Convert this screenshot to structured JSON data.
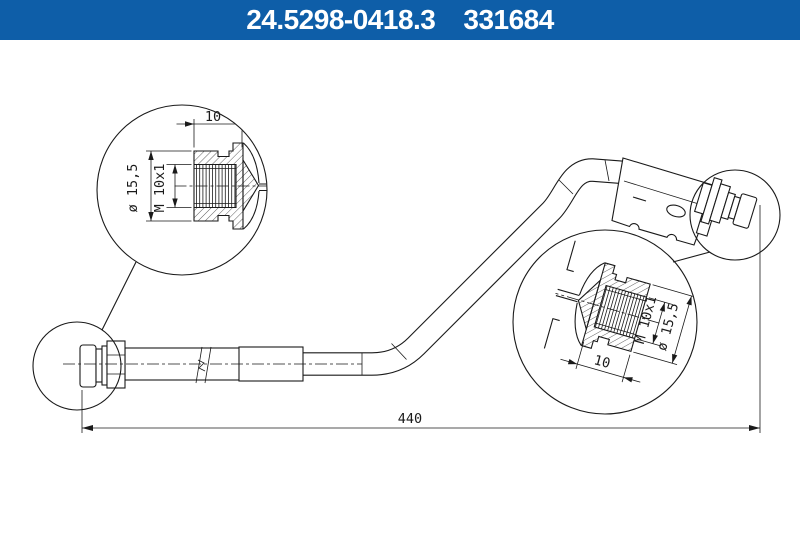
{
  "header": {
    "part_number": "24.5298-0418.3",
    "catalog_number": "331684"
  },
  "colors": {
    "header_bg": "#0e5ea8",
    "header_text": "#ffffff",
    "line": "#1a1a1a",
    "background": "#ffffff"
  },
  "dimensions": {
    "overall_length": "440"
  },
  "left_detail": {
    "length": "10",
    "thread": "M 10x1",
    "diameter": "ø 15,5"
  },
  "right_detail": {
    "length": "10",
    "thread": "M 10x1",
    "diameter": "ø 15,5"
  }
}
